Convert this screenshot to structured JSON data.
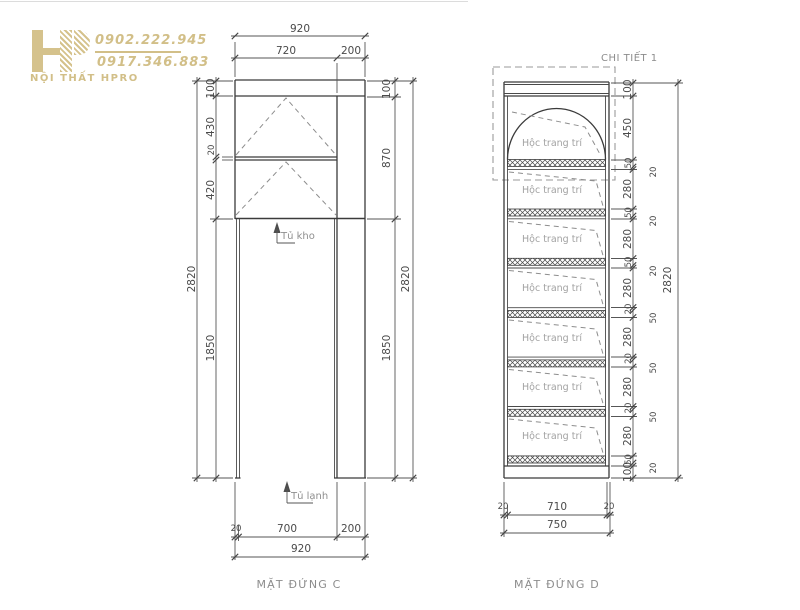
{
  "logo": {
    "brand": "NỘI THẤT HPRO",
    "phone_1": "0902.222.945",
    "phone_2": "0917.346.883",
    "color": "#d5c28c"
  },
  "elevation_c": {
    "title": "MẶT ĐỨNG C",
    "labels": {
      "storage": "Tủ kho",
      "fridge": "Tủ lạnh"
    },
    "dims": {
      "top_total": "920",
      "top_left": "720",
      "top_right": "200",
      "left_chain": [
        "100",
        "430",
        "20",
        "420",
        "1850"
      ],
      "left_total": "2820",
      "right_chain": [
        "100",
        "870",
        "1850"
      ],
      "right_total": "2820",
      "bottom_chain": [
        "20",
        "700",
        "200"
      ],
      "bottom_total": "920"
    }
  },
  "elevation_d": {
    "title": "MẶT ĐỨNG D",
    "detail_callout": "CHI TIẾT 1",
    "compartment_label": "Hộc trang trí",
    "dims": {
      "right_chain": [
        "100",
        "450",
        "50",
        "20",
        "280",
        "50",
        "20",
        "280",
        "50",
        "20",
        "280",
        "20",
        "50",
        "280",
        "20",
        "50",
        "280",
        "20",
        "50",
        "280",
        "50",
        "20",
        "100"
      ],
      "right_total": "2820",
      "bottom_chain": [
        "20",
        "710",
        "20"
      ],
      "bottom_total": "750"
    }
  }
}
